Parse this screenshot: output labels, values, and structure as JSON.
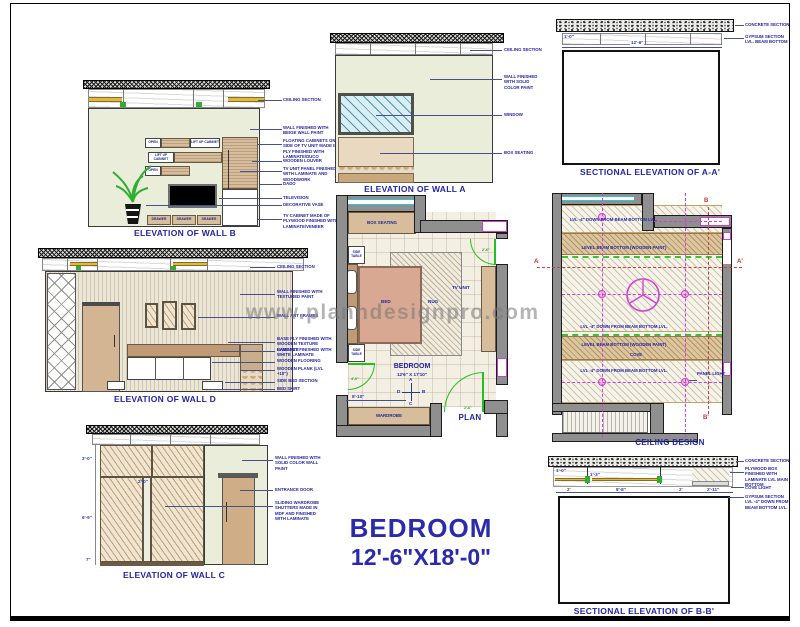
{
  "watermark": "www.planndesignpro.com",
  "main_title": {
    "room": "BEDROOM",
    "size": "12'-6\"X18'-0\""
  },
  "wall_b": {
    "title": "ELEVATION OF WALL B",
    "labels": {
      "open": "OPEN",
      "lift_up": "LIFT UP CABINET",
      "drawer": "DRAWER"
    },
    "annotations": [
      "CEILING SECTION",
      "WALL FINISHED WITH BEIGE WALL PAINT",
      "FLOATING CABINETS ON SIDE OF TV UNIT MADE IN PLY FINISHED WITH LAMINATE/DUCO",
      "WOODEN LOUVER",
      "TV UNIT PANEL FINISHED WITH LAMINATE AND WOODWORK",
      "DADO",
      "TELEVISION",
      "DECORATIVE VASE",
      "TV CABINET MADE OF PLYWOOD FINISHED WITH LAMINATE/VENEER"
    ]
  },
  "wall_a": {
    "title": "ELEVATION OF WALL A",
    "annotations": [
      "CEILING SECTION",
      "WALL FINISHED WITH SOLID COLOR PAINT",
      "WINDOW",
      "BOX SEATING"
    ]
  },
  "section_aa": {
    "title": "SECTIONAL ELEVATION OF A-A'",
    "dim_height": "1'-0\"",
    "dim_width": "12'-6\"",
    "annotations": [
      "CONCRETE SECTION",
      "GYPSUM SECTION LVL. BEAM BOTTOM"
    ]
  },
  "wall_d": {
    "title": "ELEVATION OF WALL D",
    "annotations": [
      "CEILING SECTION",
      "WALL FINISHED WITH TEXTURED PAINT",
      "WALL ART FRAMES",
      "BASE PLY FINISHED WITH WOODEN TEXTURE LAMINATE",
      "BASE PLY FINISHED WITH WHITE LAMINATE",
      "WOODEN FLOORING",
      "WOODEN PLANK (LVL +10\")",
      "SIDE BED SECTION",
      "BED SKIRT"
    ]
  },
  "plan": {
    "title": "PLAN",
    "room_label": "BEDROOM",
    "room_size": "12'6\" X 17'10\"",
    "box_seating": "BOX SEATING",
    "side_table": "SIDE TABLE",
    "bed": "BED",
    "rug": "RUG",
    "tv_unit": "TV UNIT",
    "wardrobe": "WARDROBE",
    "dim_bottom": "8'-10\"",
    "door_right": "2'-6\"",
    "door_left": "4'-0\"",
    "door_bottom": "2'-6\"",
    "compass": {
      "n": "A",
      "e": "B",
      "s": "C",
      "w": "D"
    }
  },
  "ceiling": {
    "title": "CEILING DESIGN",
    "lvl_note": "LVL -4\" DOWN FROM BEAM BOTTOM LVL.",
    "beam_note": "LEVEL BEAM BOTTOM (WOODEN PAINT)",
    "cove": "COVE",
    "panel_light": "PANEL LIGHT",
    "markers": {
      "a": "A",
      "a2": "A'",
      "b": "B",
      "b2": "B'"
    }
  },
  "wall_c": {
    "title": "ELEVATION OF WALL C",
    "dims": {
      "top": "2'-0\"",
      "mid": "6'-9\"",
      "bot": "7\"",
      "inner": "2'-0\""
    },
    "annotations": [
      "WALL FINISHED WITH SOLID COLOR WALL PAINT",
      "ENTRANCE DOOR",
      "SLIDING WARDROBE SHUTTERS MADE IN MDF AND FINISHED WITH LAMINATE"
    ]
  },
  "section_bb": {
    "title": "SECTIONAL ELEVATION OF B-B'",
    "dims": {
      "h1": "1'-0\"",
      "h2": "1'-3\"",
      "w1": "2'",
      "w2": "8'-8\"",
      "w3": "2'",
      "w4": "2'-11\""
    },
    "annotations": [
      "CONCRETE SECTION",
      "PLYWOOD BOX FINISHED WITH LAMINATE LVL MAIN BOTTOM",
      "COVE LIGHT",
      "GYPSUM SECTION LVL -4\" DOWN FROM BEAM BOTTOM LVL."
    ]
  }
}
